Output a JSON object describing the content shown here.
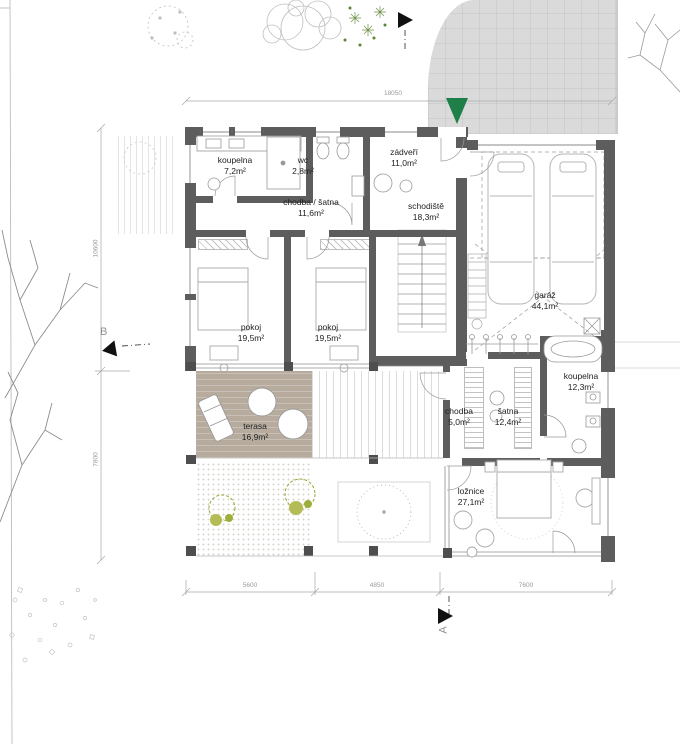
{
  "drawing": {
    "type": "architectural-floor-plan"
  },
  "colors": {
    "wall": "#5d5d5d",
    "column": "#4e4e4e",
    "terrace": "#b6ab9d",
    "driveway": "#dadada",
    "green": "#1f7f48",
    "bush": "#99a52e",
    "line": "#9a9a9a",
    "label": "#222222",
    "dim": "#9a9a9a"
  },
  "rooms": [
    {
      "name": "koupelna",
      "area": "7,2m²"
    },
    {
      "name": "wc",
      "area": "2,8m²"
    },
    {
      "name": "zádveří",
      "area": "11,0m²"
    },
    {
      "name": "chodba / šatna",
      "area": "11,6m²"
    },
    {
      "name": "schodiště",
      "area": "18,3m²"
    },
    {
      "name": "pokoj",
      "area": "19,5m²"
    },
    {
      "name": "pokoj",
      "area": "19,5m²"
    },
    {
      "name": "garáž",
      "area": "44,1m²"
    },
    {
      "name": "terasa",
      "area": "16,9m²"
    },
    {
      "name": "chodba",
      "area": "5,0m²"
    },
    {
      "name": "šatna",
      "area": "12,4m²"
    },
    {
      "name": "koupelna",
      "area": "12,3m²"
    },
    {
      "name": "ložnice",
      "area": "27,1m²"
    }
  ],
  "dimensions": {
    "top": "18050",
    "bottom_left": "5600",
    "bottom_center": "4850",
    "bottom_right": "7600",
    "side_upper": "10600",
    "side_lower": "7800"
  },
  "markers": {
    "section_a": "A",
    "section_b": "B"
  }
}
